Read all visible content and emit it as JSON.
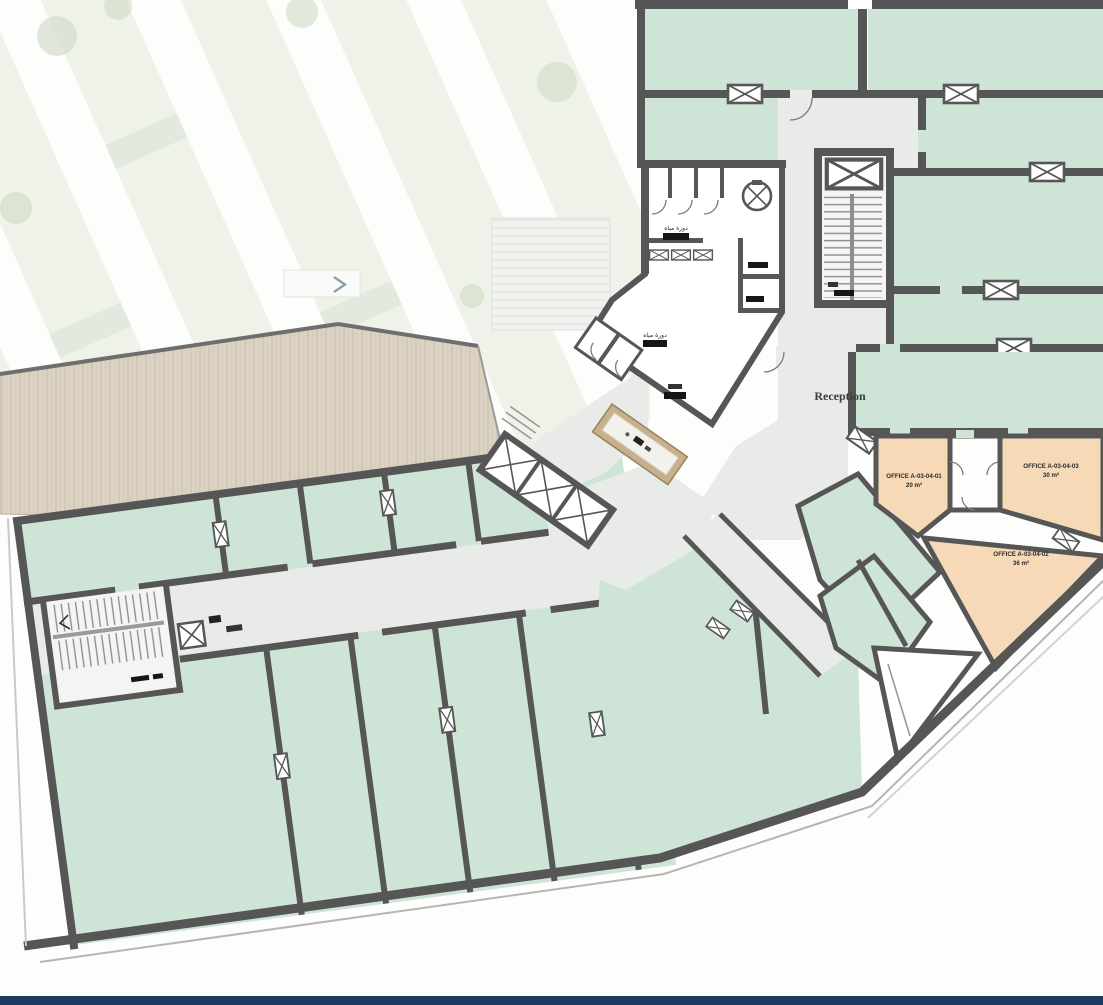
{
  "plan": {
    "reception": {
      "label": "Reception"
    },
    "offices": [
      {
        "name": "OFFICE A-03-04-01",
        "area": "20 m²"
      },
      {
        "name": "OFFICE A-03-04-03",
        "area": "30 m²"
      },
      {
        "name": "OFFICE A-03-04-02",
        "area": "36 m²"
      }
    ],
    "wet_rooms": [
      {
        "label": "دورة مياه"
      },
      {
        "label": "دورة مياه"
      }
    ],
    "colors": {
      "room_fill": "#cde4d6",
      "office_fill": "#f6d9b6",
      "wall": "#565656",
      "circulation": "#e9ebe8",
      "wood_deck": "#dbd2c3",
      "footer_bar": "#1d3b5a"
    }
  }
}
